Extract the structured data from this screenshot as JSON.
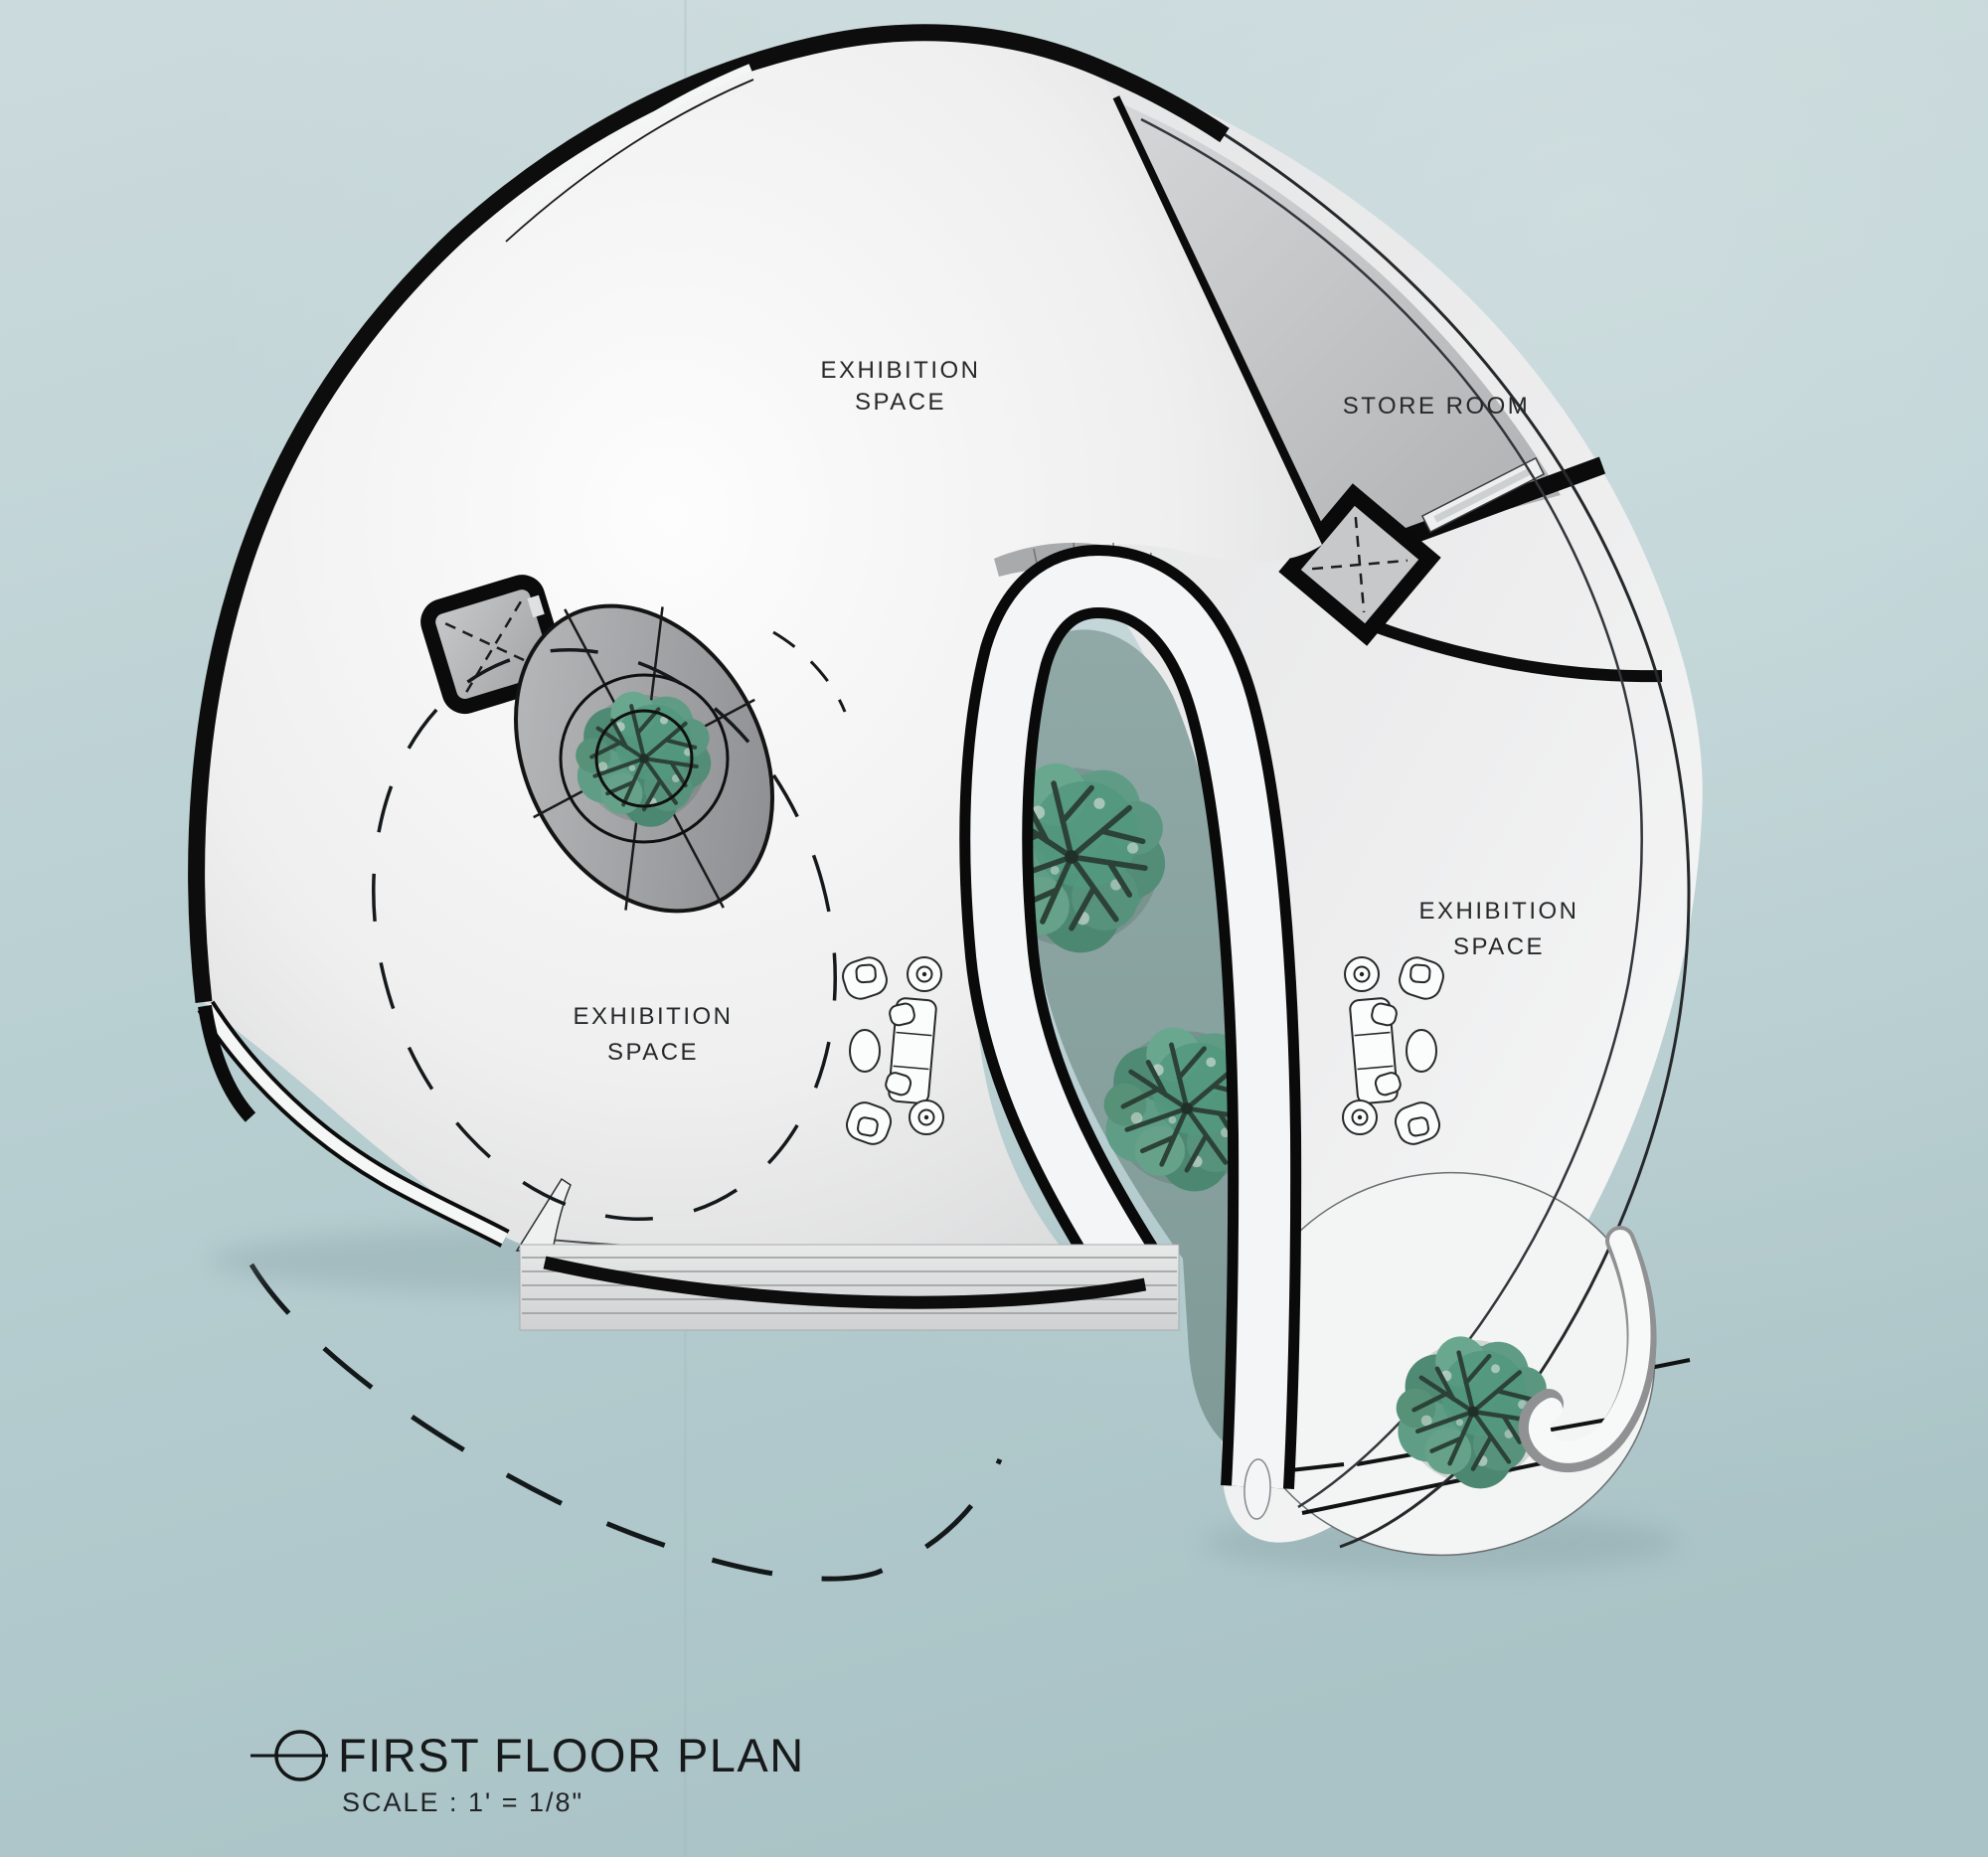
{
  "drawing": {
    "title": "FIRST FLOOR PLAN",
    "scale_note": "SCALE : 1' = 1/8\"",
    "title_marker": "section-circle-icon"
  },
  "labels": {
    "exhibition_top": {
      "line1": "EXHIBITION",
      "line2": "SPACE"
    },
    "exhibition_left": {
      "line1": "EXHIBITION",
      "line2": "SPACE"
    },
    "exhibition_right": {
      "line1": "EXHIBITION",
      "line2": "SPACE"
    },
    "store_room": "STORE ROOM"
  },
  "plan": {
    "rooms": [
      {
        "name": "Exhibition Space (upper hall)",
        "label": "EXHIBITION SPACE"
      },
      {
        "name": "Exhibition Space (lower left hall)",
        "label": "EXHIBITION SPACE"
      },
      {
        "name": "Exhibition Space (right wing)",
        "label": "EXHIBITION SPACE"
      },
      {
        "name": "Store Room",
        "label": "STORE ROOM"
      }
    ],
    "features": [
      {
        "name": "elevator-shaft-left",
        "type": "elevator with dashed X"
      },
      {
        "name": "elevator-shaft-store",
        "type": "diamond elevator with dashed X"
      },
      {
        "name": "circular-tree-planter",
        "type": "oval planter disc with rings"
      },
      {
        "name": "courtyard",
        "type": "open court with trees"
      },
      {
        "name": "entrance-steps",
        "type": "stepped entry platform"
      },
      {
        "name": "seating-group-left",
        "type": "sofa, armchairs, tables"
      },
      {
        "name": "seating-group-right",
        "type": "sofa, armchairs, tables"
      },
      {
        "name": "site-boundary",
        "type": "dashed curve"
      }
    ],
    "tree_count": 4
  },
  "colors": {
    "background": "#b7ced1",
    "wall": "#0d0d0d",
    "floor": "#f5f6f6",
    "floor_shadow": "#d8d9da",
    "store_floor": "#c3c5c7",
    "courtyard": "#8ba4a2",
    "foliage": "#55917c",
    "branches": "#2e4438"
  }
}
